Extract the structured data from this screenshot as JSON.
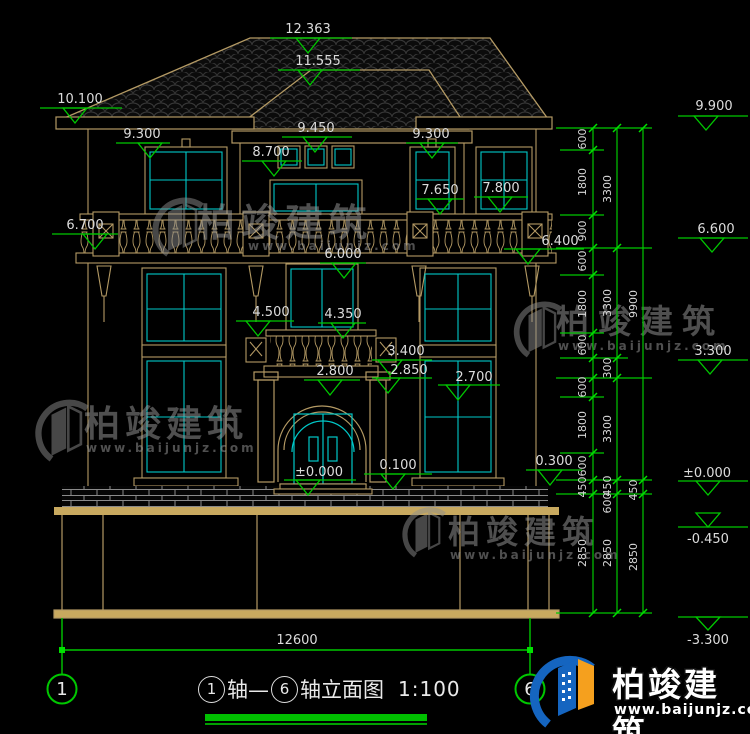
{
  "levels": {
    "v12_363": "12.363",
    "v11_555": "11.555",
    "v10_100": "10.100",
    "v9_300_left": "9.300",
    "v9_450": "9.450",
    "v8_700": "8.700",
    "v9_300_right": "9.300",
    "v7_650": "7.650",
    "v7_800": "7.800",
    "v6_700": "6.700",
    "v6_400": "6.400",
    "v6_000": "6.000",
    "v4_500": "4.500",
    "v4_350": "4.350",
    "v3_400": "3.400",
    "v2_850": "2.850",
    "v2_800": "2.800",
    "v2_700": "2.700",
    "v0_300": "0.300",
    "v0_100": "0.100",
    "v0_000_center": "±0.000",
    "v9_900": "9.900",
    "v6_600": "6.600",
    "v3_300": "3.300",
    "v0_000_right": "±0.000",
    "vn0_450": "-0.450",
    "vn3_300": "-3.300"
  },
  "dims": {
    "col1": [
      "600",
      "1800",
      "900",
      "600",
      "1800",
      "600",
      "600",
      "1800",
      "600",
      "450",
      "2850"
    ],
    "col2": [
      "3300",
      "3300",
      "300",
      "3300",
      "450",
      "600",
      "2850"
    ],
    "col3": [
      "9900",
      "450",
      "2850"
    ],
    "total_width": "12600"
  },
  "axes": {
    "start": "1",
    "end": "6"
  },
  "title": {
    "axis_start": "1",
    "mid": "轴—",
    "axis_end": "6",
    "suffix": "轴立面图",
    "scale": "1:100"
  },
  "watermark": {
    "name": "柏竣建筑",
    "url": "www.baijunjz.com"
  },
  "brand": {
    "name": "柏竣建筑",
    "url": "www.baijunjz.com"
  }
}
